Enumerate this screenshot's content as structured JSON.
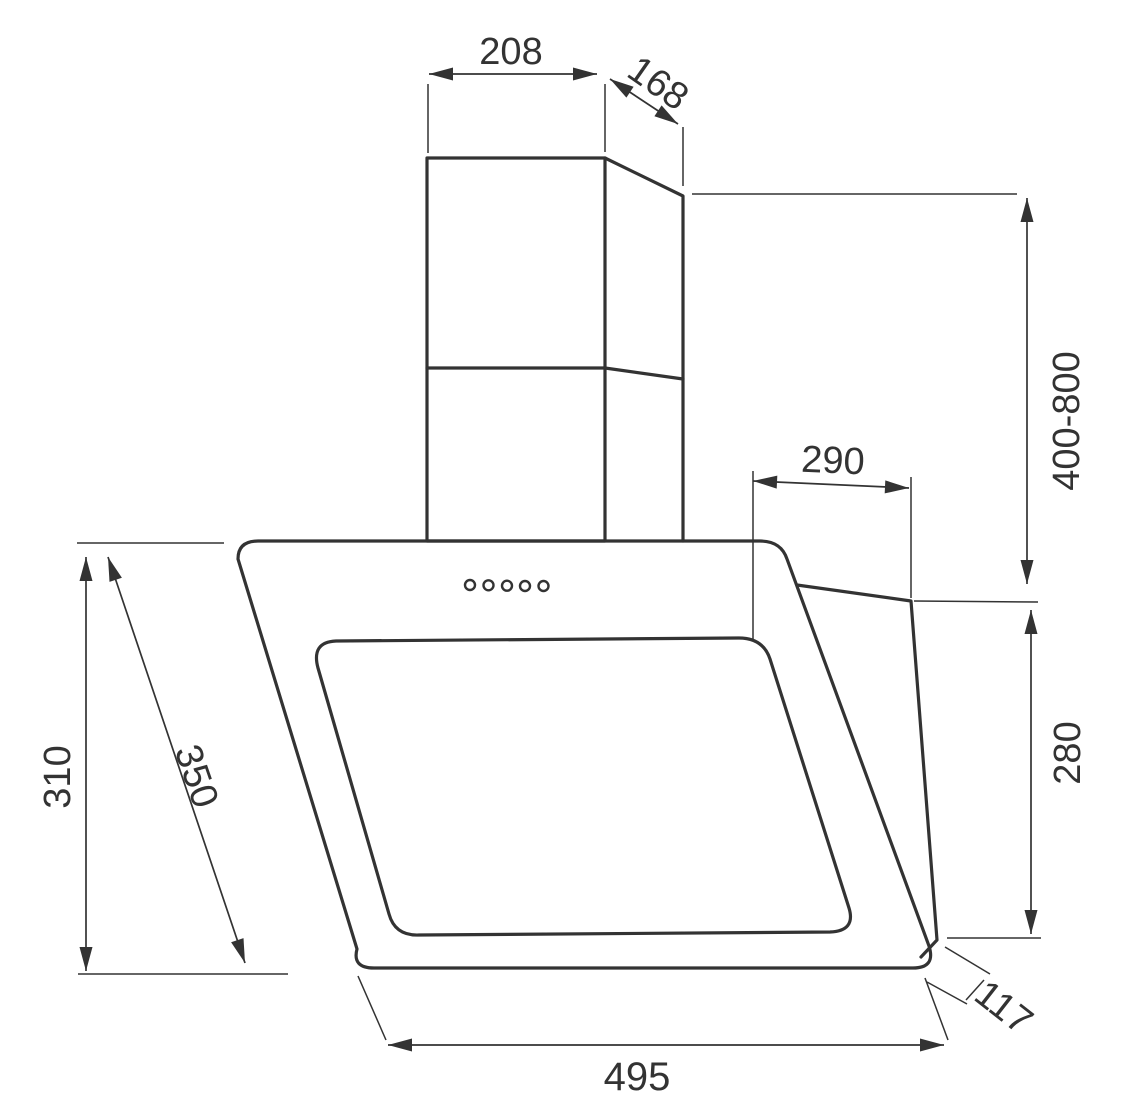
{
  "diagram": {
    "subject": "wall-mounted angled cooker hood with telescopic chimney",
    "view": "dimensioned front-side technical drawing",
    "units": "mm",
    "style": {
      "line_color": "#333333",
      "background_color": "#ffffff"
    },
    "controls": {
      "button_count": 5
    },
    "dimensions": {
      "chimney_width": {
        "label": "208"
      },
      "chimney_depth": {
        "label": "168"
      },
      "chimney_height_range": {
        "label": "400-800"
      },
      "body_top_depth": {
        "label": "290"
      },
      "body_rear_height": {
        "label": "280"
      },
      "body_height": {
        "label": "310"
      },
      "front_panel_length": {
        "label": "350"
      },
      "body_width": {
        "label": "495"
      },
      "body_bottom_depth": {
        "label": "117"
      }
    }
  }
}
